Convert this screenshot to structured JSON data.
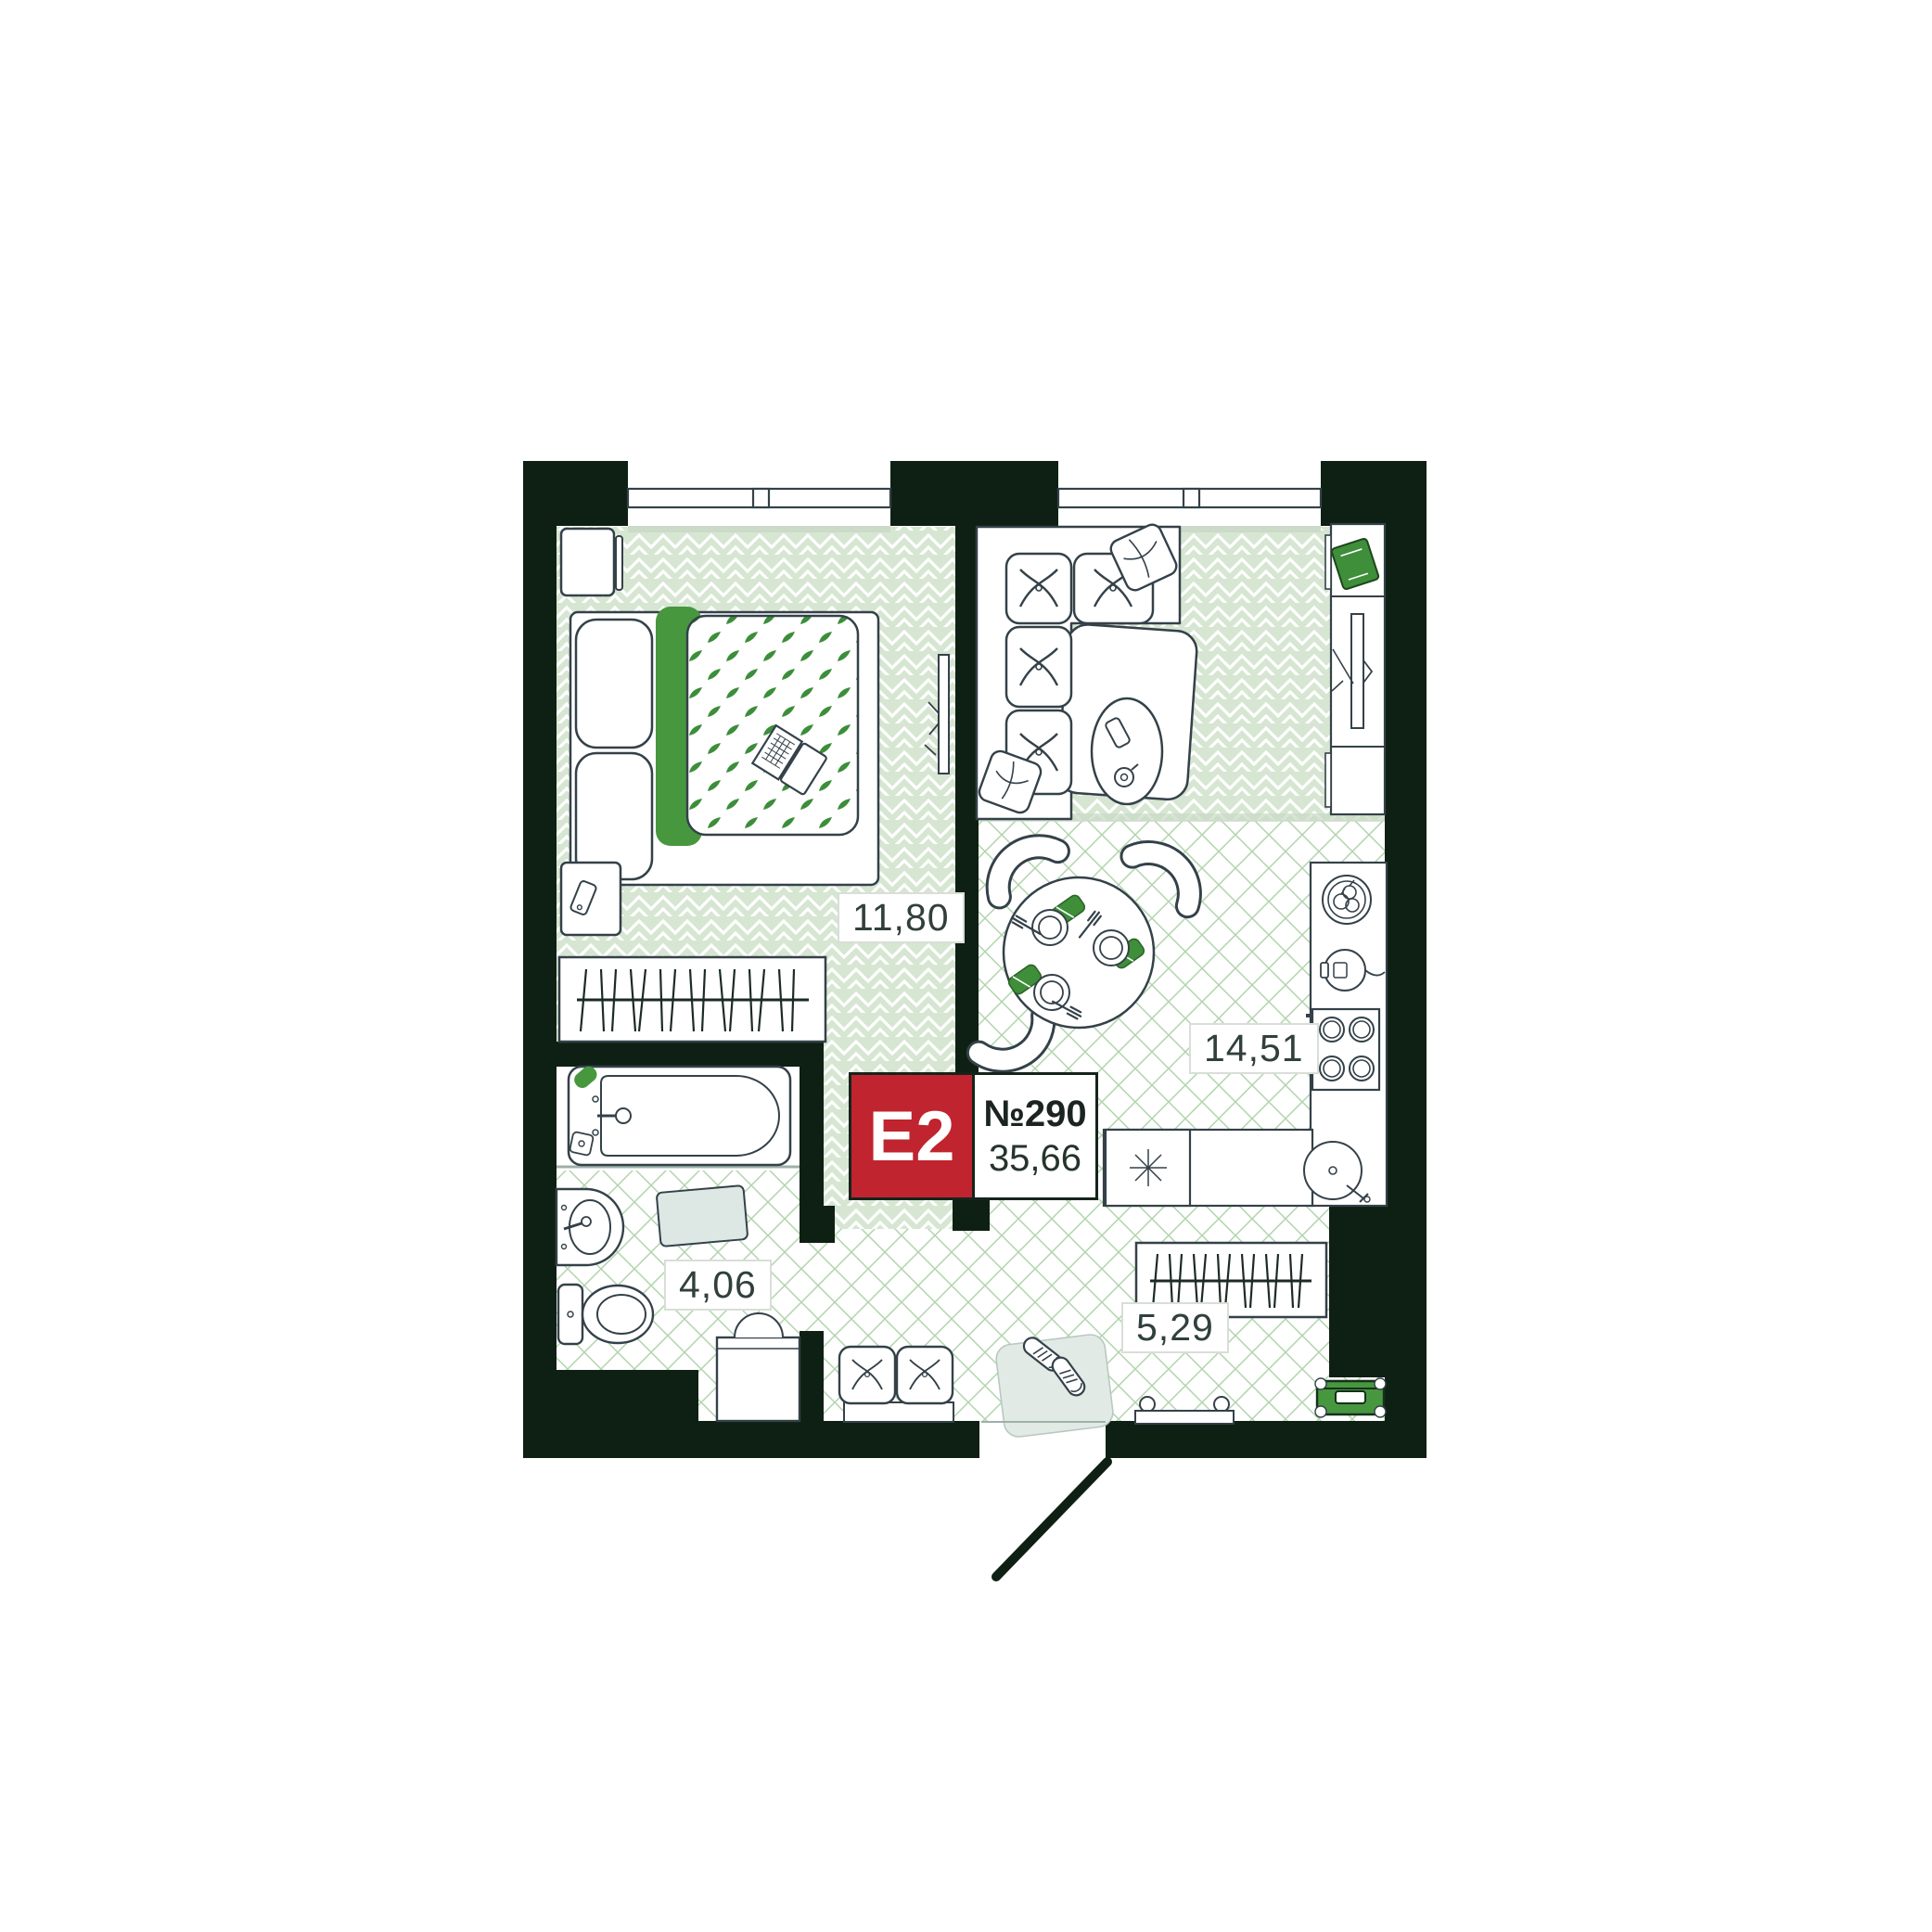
{
  "plan": {
    "badge": {
      "type_label": "E2",
      "unit_number": "№290",
      "total_area": "35,66"
    },
    "rooms": [
      {
        "id": "bedroom",
        "area_label": "11,80",
        "floor": "herringbone",
        "furniture": [
          "double-bed",
          "pillows",
          "leaf-blanket",
          "laptop",
          "nightstand",
          "bedside-table",
          "wardrobe-hangers",
          "sliding-door-leaf"
        ]
      },
      {
        "id": "kitchen-living",
        "area_label": "14,51",
        "floor": "lattice",
        "furniture": [
          "corner-sofa",
          "sofa-pillows",
          "coffee-table",
          "phone",
          "coffee-cup",
          "tv-console",
          "green-book",
          "tv",
          "dining-table",
          "chairs",
          "plates",
          "forks",
          "napkins",
          "fruit-plate",
          "kettle",
          "stove",
          "kitchen-sink",
          "dishwasher",
          "counter"
        ]
      },
      {
        "id": "bathroom",
        "area_label": "4,06",
        "floor": "lattice",
        "furniture": [
          "bathtub",
          "faucet",
          "soap",
          "washbasin",
          "toilet",
          "bath-mat"
        ]
      },
      {
        "id": "hallway",
        "area_label": "5,29",
        "floor": "lattice",
        "furniture": [
          "washing-machine",
          "pouf",
          "shoe-mat",
          "sneakers",
          "wardrobe-hangers",
          "bench",
          "green-suitcase",
          "entrance-door"
        ]
      }
    ],
    "colors": {
      "wall": "#0e2013",
      "outline": "#344149",
      "badge_red": "#c0242f",
      "accent_green": "#47973f",
      "leaf_green": "#3c8e3a",
      "herringbone_base": "#d6e6d2",
      "lattice_green": "#a3cd9e",
      "label_text": "#31403d"
    }
  }
}
